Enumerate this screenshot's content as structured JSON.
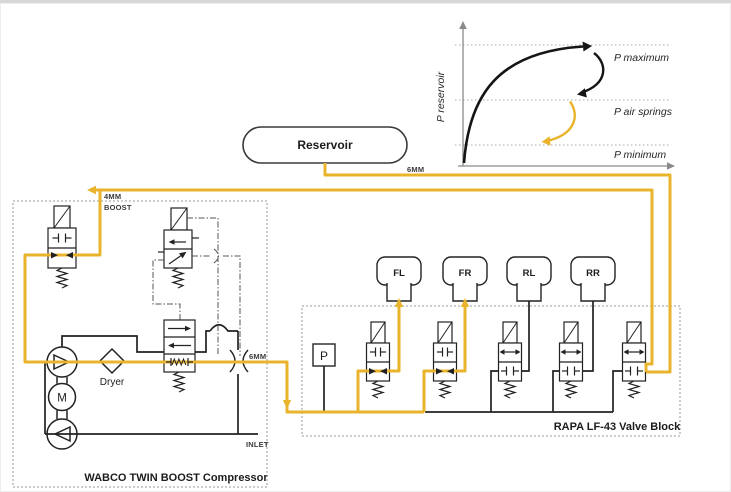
{
  "reservoir_label": "Reservoir",
  "graph": {
    "y_axis_label": "P reservoir",
    "band_labels": [
      "P maximum",
      "P air springs",
      "P minimum"
    ],
    "curve_colors": [
      "#151515",
      "#151515",
      "#E9B42C"
    ]
  },
  "lines": {
    "supply_6mm": "6MM",
    "boost_line1": "4MM",
    "boost_line2": "BOOST",
    "outlet_6mm": "6MM",
    "inlet": "INLET"
  },
  "compressor": {
    "title": "WABCO TWIN BOOST Compressor",
    "dryer": "Dryer",
    "motor": "M"
  },
  "valve_block": {
    "title": "RAPA LF-43 Valve Block",
    "pressure_port": "P",
    "air_springs": [
      "FL",
      "FR",
      "RL",
      "RR"
    ]
  },
  "colors": {
    "accent_yellow": "#E9B42C",
    "line_black": "#222222",
    "border_gray": "#999999"
  }
}
